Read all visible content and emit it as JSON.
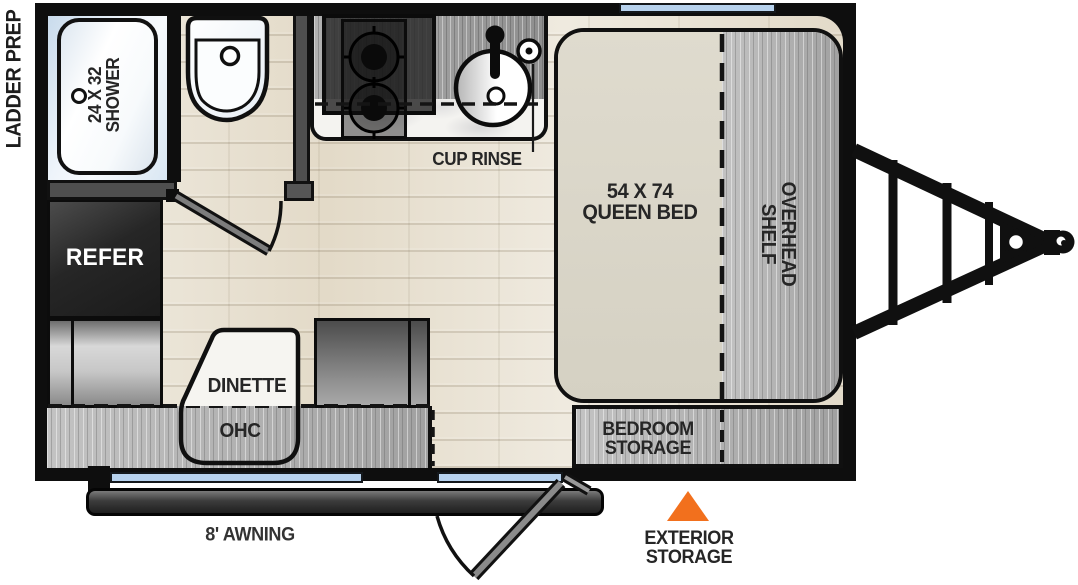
{
  "floorplan": {
    "exterior": {
      "ladder_prep_label": "LADDER PREP",
      "awning_label": "8' AWNING",
      "exterior_storage_label": {
        "line1": "EXTERIOR",
        "line2": "STORAGE"
      },
      "marker_color": "#F2701D"
    },
    "bathroom": {
      "shower_label": {
        "line1": "24 X 32",
        "line2": "SHOWER"
      }
    },
    "kitchen": {
      "refer_label": "REFER",
      "cup_rinse_label": "CUP RINSE"
    },
    "bedroom": {
      "bed_label": {
        "line1": "54 X 74",
        "line2": "QUEEN BED"
      },
      "overhead_shelf_label": {
        "line1": "OVERHEAD",
        "line2": "SHELF"
      },
      "bedroom_storage_label": {
        "line1": "BEDROOM",
        "line2": "STORAGE"
      }
    },
    "dinette": {
      "table_label": "DINETTE",
      "ohc_label": "OHC"
    }
  }
}
